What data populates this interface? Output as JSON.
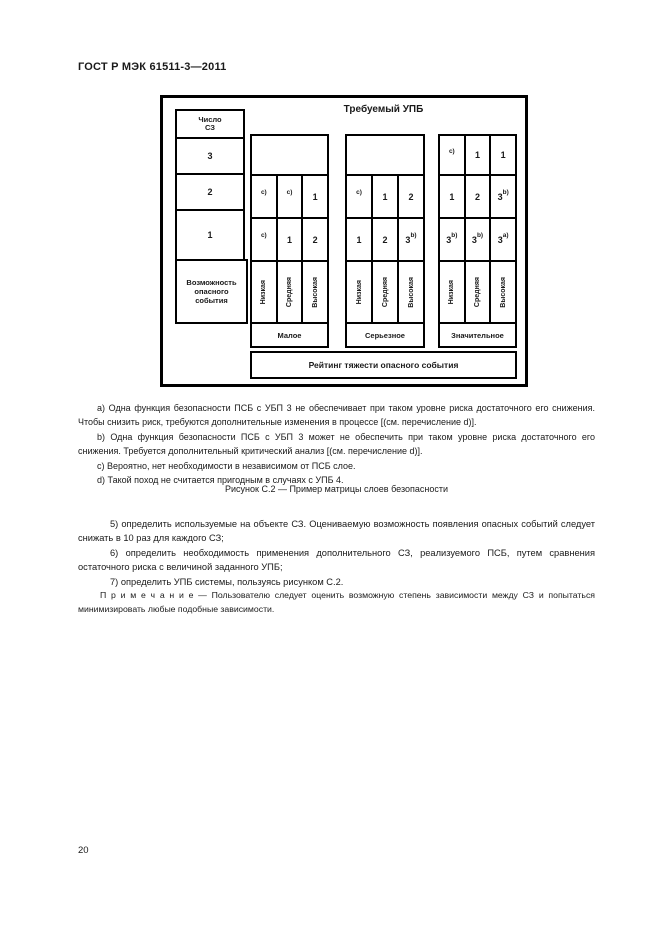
{
  "page": {
    "header": "ГОСТ Р МЭК 61511-3—2011",
    "page_number": "20"
  },
  "colors": {
    "ink": "#1a1a1a",
    "paper": "#ffffff"
  },
  "figure": {
    "title": "Требуемый УПБ",
    "layers_header_line1": "Число",
    "layers_header_line2": "СЗ",
    "layer_counts": [
      "3",
      "2",
      "1"
    ],
    "likelihood_label": "Возможность опасного события",
    "likelihood_levels": [
      "Низкая",
      "Средняя",
      "Высокая"
    ],
    "severity_axis_label": "Рейтинг тяжести опасного события",
    "groups": [
      {
        "label": "Малое",
        "r2": [
          {
            "v": "",
            "s": "c)"
          },
          {
            "v": "",
            "s": "c)"
          },
          {
            "v": "1",
            "s": ""
          }
        ],
        "r1": [
          {
            "v": "",
            "s": "c)"
          },
          {
            "v": "1",
            "s": ""
          },
          {
            "v": "2",
            "s": ""
          }
        ]
      },
      {
        "label": "Серьезное",
        "r2": [
          {
            "v": "",
            "s": "c)"
          },
          {
            "v": "1",
            "s": ""
          },
          {
            "v": "2",
            "s": ""
          }
        ],
        "r1": [
          {
            "v": "1",
            "s": ""
          },
          {
            "v": "2",
            "s": ""
          },
          {
            "v": "3",
            "s": "b)"
          }
        ]
      },
      {
        "label": "Значительное",
        "r3": [
          {
            "v": "",
            "s": "c)"
          },
          {
            "v": "1",
            "s": ""
          },
          {
            "v": "1",
            "s": ""
          }
        ],
        "r2": [
          {
            "v": "1",
            "s": ""
          },
          {
            "v": "2",
            "s": ""
          },
          {
            "v": "3",
            "s": "b)"
          }
        ],
        "r1": [
          {
            "v": "3",
            "s": "b)"
          },
          {
            "v": "3",
            "s": "b)"
          },
          {
            "v": "3",
            "s": "a)"
          }
        ]
      }
    ]
  },
  "notes": [
    "a) Одна функция безопасности ПСБ с УБП 3 не обеспечивает при таком уровне риска достаточного его снижения. Чтобы снизить риск, требуются дополнительные изменения в процессе [(см. перечисление d)].",
    "b) Одна функция безопасности ПСБ с УБП 3 может не обеспечить при таком уровне риска достаточного его снижения. Требуется дополнительный критический анализ [(см. перечисление d)].",
    "c) Вероятно, нет необходимости в независимом от ПСБ слое.",
    "d) Такой поход не считается пригодным в случаях с УПБ 4."
  ],
  "caption": "Рисунок С.2 — Пример матрицы слоев безопасности",
  "list_items": [
    "5) определить используемые на объекте СЗ. Оцениваемую возможность появления опасных событий следует снижать в 10 раз для каждого СЗ;",
    "6) определить необходимость применения дополнительного СЗ, реализуемого ПСБ, путем сравнения остаточного риска с величиной заданного УПБ;",
    "7) определить УПБ системы, пользуясь рисунком С.2."
  ],
  "note_paragraph": "П р и м е ч а н и е — Пользователю следует оценить возможную степень зависимости между СЗ и попытаться минимизировать любые подобные зависимости."
}
